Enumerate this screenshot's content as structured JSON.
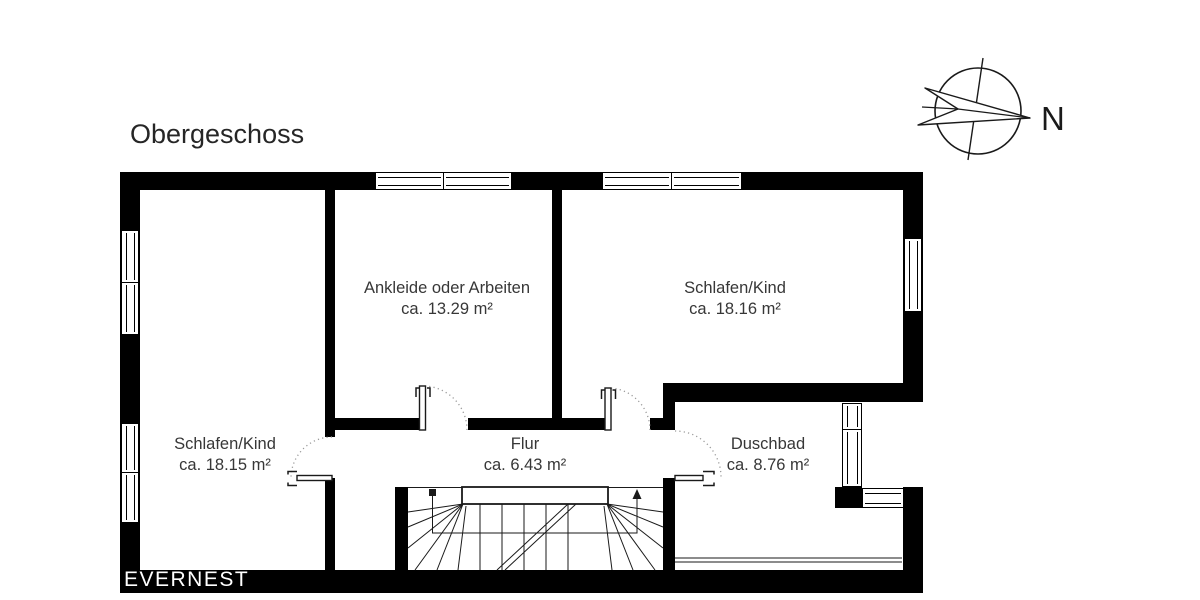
{
  "title": "Obergeschoss",
  "watermark": "EVERNEST",
  "compass": {
    "label": "N"
  },
  "colors": {
    "wall": "#000000",
    "line": "#1a1a1a",
    "text": "#373737",
    "background": "#ffffff",
    "watermark_text": "#ffffff",
    "door_arc": "#9a9a9a"
  },
  "rooms": [
    {
      "name": "Ankleide oder Arbeiten",
      "area": "ca. 13.29 m²"
    },
    {
      "name": "Schlafen/Kind",
      "area": "ca. 18.16 m²"
    },
    {
      "name": "Schlafen/Kind",
      "area": "ca. 18.15 m²"
    },
    {
      "name": "Flur",
      "area": "ca. 6.43 m²"
    },
    {
      "name": "Duschbad",
      "area": "ca. 8.76 m²"
    }
  ]
}
